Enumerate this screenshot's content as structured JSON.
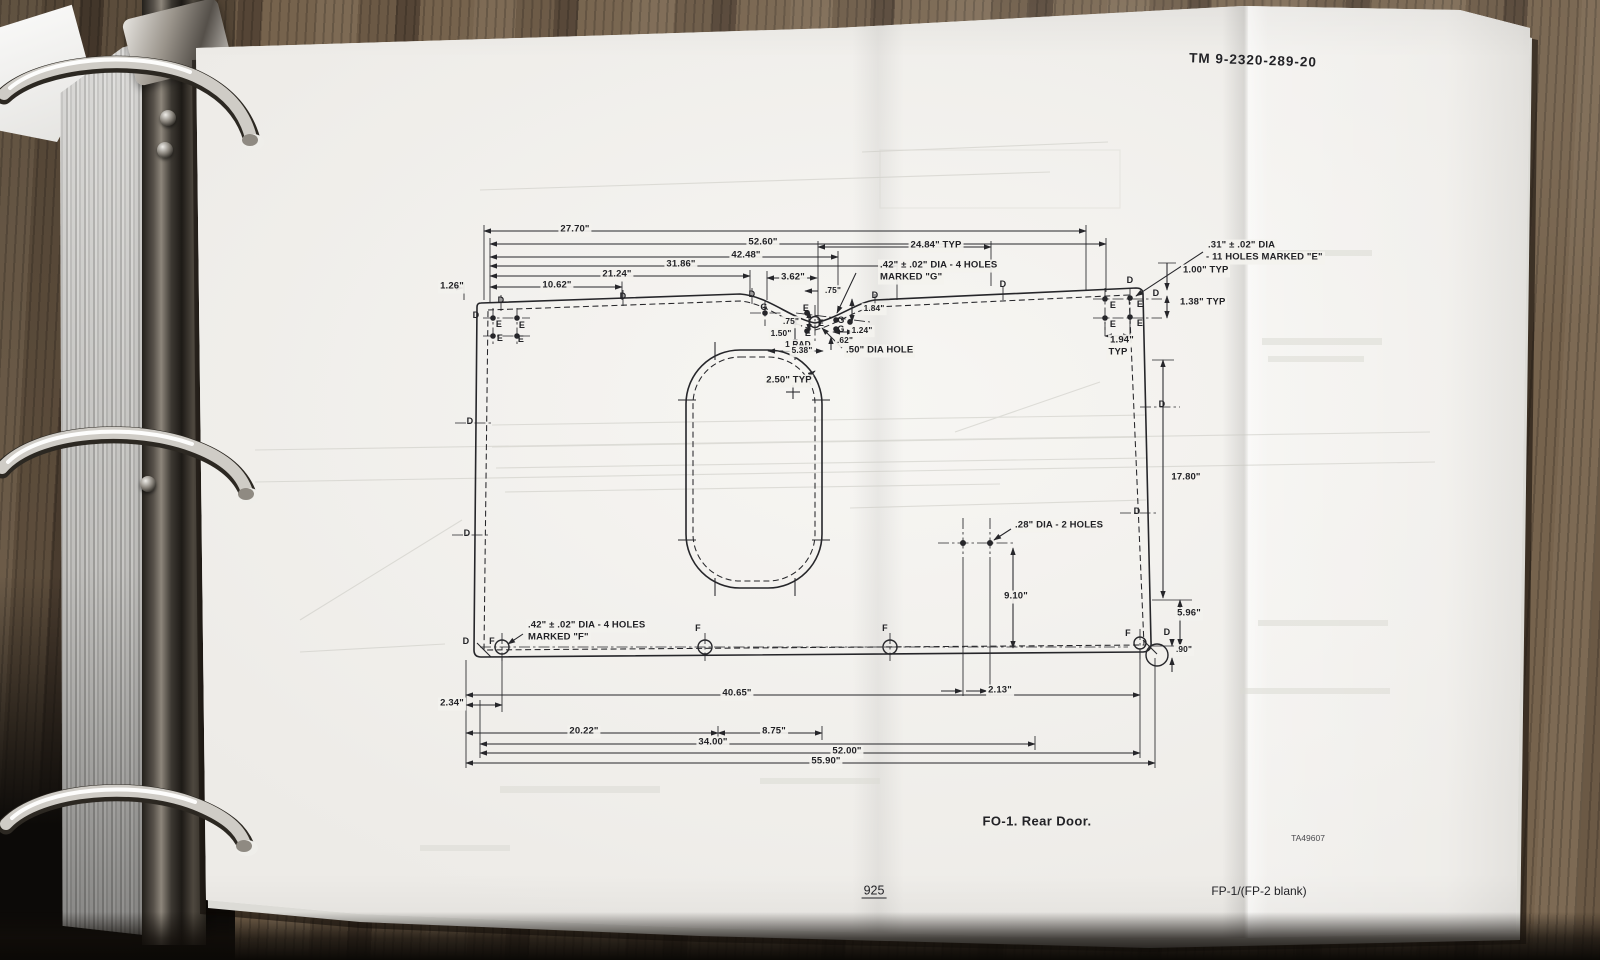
{
  "page": {
    "header_tm": "TM  9-2320-289-20",
    "figure_caption": "FO-1. Rear Door.",
    "plate_number": "TA49607",
    "page_number": "925",
    "footer_right": "FP-1/(FP-2 blank)"
  },
  "drawing": {
    "figure": "Rear Door dimensional drawing",
    "labels": [
      {
        "t": "27.70\"",
        "x": 575,
        "y": 230
      },
      {
        "t": "52.60\"",
        "x": 763,
        "y": 243
      },
      {
        "t": "24.84\" TYP",
        "x": 936,
        "y": 246
      },
      {
        "t": "42.48\"",
        "x": 746,
        "y": 256
      },
      {
        "t": "31.86\"",
        "x": 681,
        "y": 265
      },
      {
        "t": "21.24\"",
        "x": 617,
        "y": 275
      },
      {
        "t": "10.62\"",
        "x": 557,
        "y": 286
      },
      {
        "t": "1.26\"",
        "x": 452,
        "y": 287
      },
      {
        "t": "3.62\"",
        "x": 793,
        "y": 278
      },
      {
        "t": ".75\"",
        "x": 833,
        "y": 291,
        "c": "sm"
      },
      {
        "t": ".42\" ± .02\" DIA - 4 HOLES",
        "x": 878,
        "y": 266,
        "c": "l",
        "n": "note-holes-g"
      },
      {
        "t": "MARKED \"G\"",
        "x": 878,
        "y": 278,
        "c": "l",
        "n": "note-holes-g"
      },
      {
        "t": ".31\" ± .02\" DIA",
        "x": 1206,
        "y": 246,
        "c": "l",
        "n": "note-holes-e"
      },
      {
        "t": "- 11 HOLES MARKED \"E\"",
        "x": 1204,
        "y": 258,
        "c": "l",
        "n": "note-holes-e"
      },
      {
        "t": "1.00\" TYP",
        "x": 1181,
        "y": 271,
        "c": "l"
      },
      {
        "t": "1.38\" TYP",
        "x": 1178,
        "y": 303,
        "c": "l"
      },
      {
        "t": "1.94\"",
        "x": 1122,
        "y": 341
      },
      {
        "t": "TYP",
        "x": 1118,
        "y": 353
      },
      {
        "t": "1.84\"",
        "x": 874,
        "y": 309,
        "c": "sm"
      },
      {
        "t": ".75\"",
        "x": 791,
        "y": 322,
        "c": "sm"
      },
      {
        "t": "1.50\"",
        "x": 781,
        "y": 334,
        "c": "sm"
      },
      {
        "t": "1.24\"",
        "x": 862,
        "y": 331,
        "c": "sm"
      },
      {
        "t": ".62\"",
        "x": 845,
        "y": 341,
        "c": "sm"
      },
      {
        "t": "1 RAD",
        "x": 798,
        "y": 345,
        "c": "sm"
      },
      {
        "t": "5.38\"",
        "x": 802,
        "y": 351,
        "c": "sm"
      },
      {
        "t": ".50\" DIA HOLE",
        "x": 844,
        "y": 351,
        "c": "l",
        "n": "note-dia-hole"
      },
      {
        "t": "2.50\" TYP",
        "x": 789,
        "y": 381
      },
      {
        "t": "17.80\"",
        "x": 1186,
        "y": 478
      },
      {
        "t": ".28\" DIA - 2 HOLES",
        "x": 1013,
        "y": 526,
        "c": "l",
        "n": "note-holes-28"
      },
      {
        "t": "9.10\"",
        "x": 1016,
        "y": 597
      },
      {
        "t": "5.96\"",
        "x": 1189,
        "y": 614
      },
      {
        "t": ".90\"",
        "x": 1184,
        "y": 650,
        "c": "sm"
      },
      {
        "t": ".42\" ± .02\" DIA - 4 HOLES",
        "x": 526,
        "y": 626,
        "c": "l",
        "n": "note-holes-f"
      },
      {
        "t": "MARKED \"F\"",
        "x": 526,
        "y": 638,
        "c": "l",
        "n": "note-holes-f"
      },
      {
        "t": "2.34\"",
        "x": 452,
        "y": 704
      },
      {
        "t": "40.65\"",
        "x": 737,
        "y": 694
      },
      {
        "t": "2.13\"",
        "x": 1000,
        "y": 691
      },
      {
        "t": "20.22\"",
        "x": 584,
        "y": 732
      },
      {
        "t": "8.75\"",
        "x": 774,
        "y": 732
      },
      {
        "t": "34.00\"",
        "x": 713,
        "y": 743
      },
      {
        "t": "52.00\"",
        "x": 847,
        "y": 752
      },
      {
        "t": "55.90\"",
        "x": 826,
        "y": 762
      },
      {
        "t": "D",
        "x": 476,
        "y": 315,
        "c": "lt",
        "n": "hole-letter-d"
      },
      {
        "t": "D",
        "x": 501,
        "y": 300,
        "c": "lt",
        "n": "hole-letter-d"
      },
      {
        "t": "D",
        "x": 623,
        "y": 296,
        "c": "lt",
        "n": "hole-letter-d"
      },
      {
        "t": "D",
        "x": 752,
        "y": 294,
        "c": "lt",
        "n": "hole-letter-d"
      },
      {
        "t": "D",
        "x": 875,
        "y": 295,
        "c": "lt",
        "n": "hole-letter-d"
      },
      {
        "t": "D",
        "x": 1003,
        "y": 284,
        "c": "lt",
        "n": "hole-letter-d"
      },
      {
        "t": "D",
        "x": 1130,
        "y": 280,
        "c": "lt",
        "n": "hole-letter-d"
      },
      {
        "t": "D",
        "x": 1156,
        "y": 293,
        "c": "lt",
        "n": "hole-letter-d"
      },
      {
        "t": "D",
        "x": 470,
        "y": 421,
        "c": "lt",
        "n": "hole-letter-d"
      },
      {
        "t": "D",
        "x": 467,
        "y": 533,
        "c": "lt",
        "n": "hole-letter-d"
      },
      {
        "t": "D",
        "x": 1162,
        "y": 404,
        "c": "lt",
        "n": "hole-letter-d"
      },
      {
        "t": "D",
        "x": 1137,
        "y": 511,
        "c": "lt",
        "n": "hole-letter-d"
      },
      {
        "t": "D",
        "x": 466,
        "y": 641,
        "c": "lt",
        "n": "hole-letter-d"
      },
      {
        "t": "D",
        "x": 1167,
        "y": 632,
        "c": "lt",
        "n": "hole-letter-d"
      },
      {
        "t": "E",
        "x": 499,
        "y": 324,
        "c": "lt",
        "n": "hole-letter-e"
      },
      {
        "t": "E",
        "x": 522,
        "y": 325,
        "c": "lt",
        "n": "hole-letter-e"
      },
      {
        "t": "E",
        "x": 500,
        "y": 338,
        "c": "lt",
        "n": "hole-letter-e"
      },
      {
        "t": "E",
        "x": 521,
        "y": 339,
        "c": "lt",
        "n": "hole-letter-e"
      },
      {
        "t": "E",
        "x": 806,
        "y": 308,
        "c": "lt",
        "n": "hole-letter-e"
      },
      {
        "t": "E",
        "x": 821,
        "y": 323,
        "c": "lt",
        "n": "hole-letter-e"
      },
      {
        "t": "E",
        "x": 808,
        "y": 333,
        "c": "lt",
        "n": "hole-letter-e"
      },
      {
        "t": "E",
        "x": 1113,
        "y": 305,
        "c": "lt",
        "n": "hole-letter-e"
      },
      {
        "t": "E",
        "x": 1140,
        "y": 304,
        "c": "lt",
        "n": "hole-letter-e"
      },
      {
        "t": "E",
        "x": 1113,
        "y": 324,
        "c": "lt",
        "n": "hole-letter-e"
      },
      {
        "t": "E",
        "x": 1140,
        "y": 323,
        "c": "lt",
        "n": "hole-letter-e"
      },
      {
        "t": "G",
        "x": 764,
        "y": 307,
        "c": "lt",
        "n": "hole-letter-g"
      },
      {
        "t": "G",
        "x": 841,
        "y": 320,
        "c": "lt",
        "n": "hole-letter-g"
      },
      {
        "t": "G",
        "x": 841,
        "y": 329,
        "c": "lt",
        "n": "hole-letter-g"
      },
      {
        "t": "F",
        "x": 492,
        "y": 641,
        "c": "lt",
        "n": "hole-letter-f"
      },
      {
        "t": "F",
        "x": 698,
        "y": 628,
        "c": "lt",
        "n": "hole-letter-f"
      },
      {
        "t": "F",
        "x": 885,
        "y": 628,
        "c": "lt",
        "n": "hole-letter-f"
      },
      {
        "t": "F",
        "x": 1128,
        "y": 633,
        "c": "lt",
        "n": "hole-letter-f"
      }
    ]
  },
  "colors": {
    "ink": "#26262a",
    "paper": "#f1f0ec",
    "wood": "#6b5945",
    "metal": "#8d867b"
  }
}
